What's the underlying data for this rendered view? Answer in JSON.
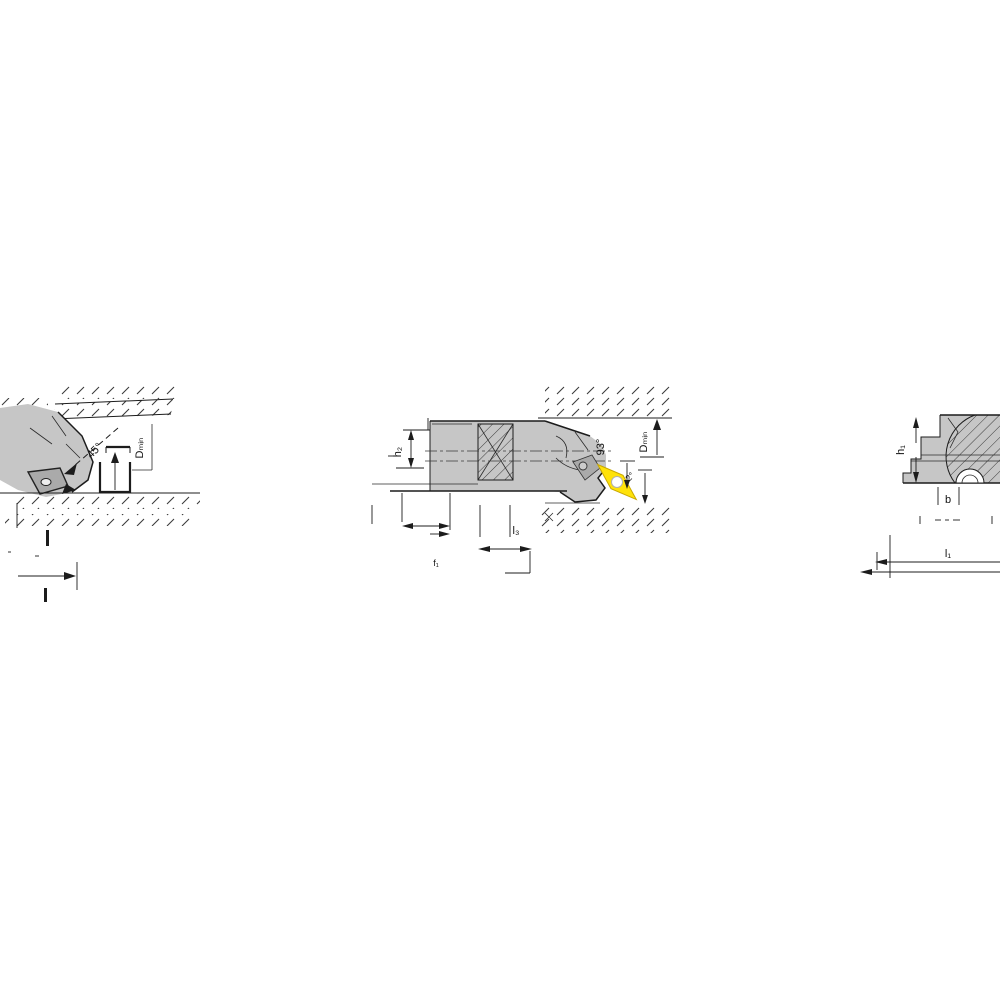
{
  "labels": {
    "left": {
      "angle": "45°",
      "dmin": "Dₘᵢₙ"
    },
    "middle": {
      "h2": "h₂",
      "entering_angle": "93°",
      "clearance_angle": "2°",
      "dmin": "Dₘᵢₙ",
      "f1": "f₁",
      "l3": "l₃"
    },
    "right": {
      "h1": "h₁",
      "b": "b",
      "l1": "l₁"
    }
  },
  "colors": {
    "background": "#ffffff",
    "body_gray": "#c6c6c6",
    "detail_gray": "#aaaaaa",
    "line": "#1c1c1c",
    "insert_yellow": "#ffe20a",
    "insert_edge": "#c9a800",
    "hole_white": "#ffffff"
  }
}
